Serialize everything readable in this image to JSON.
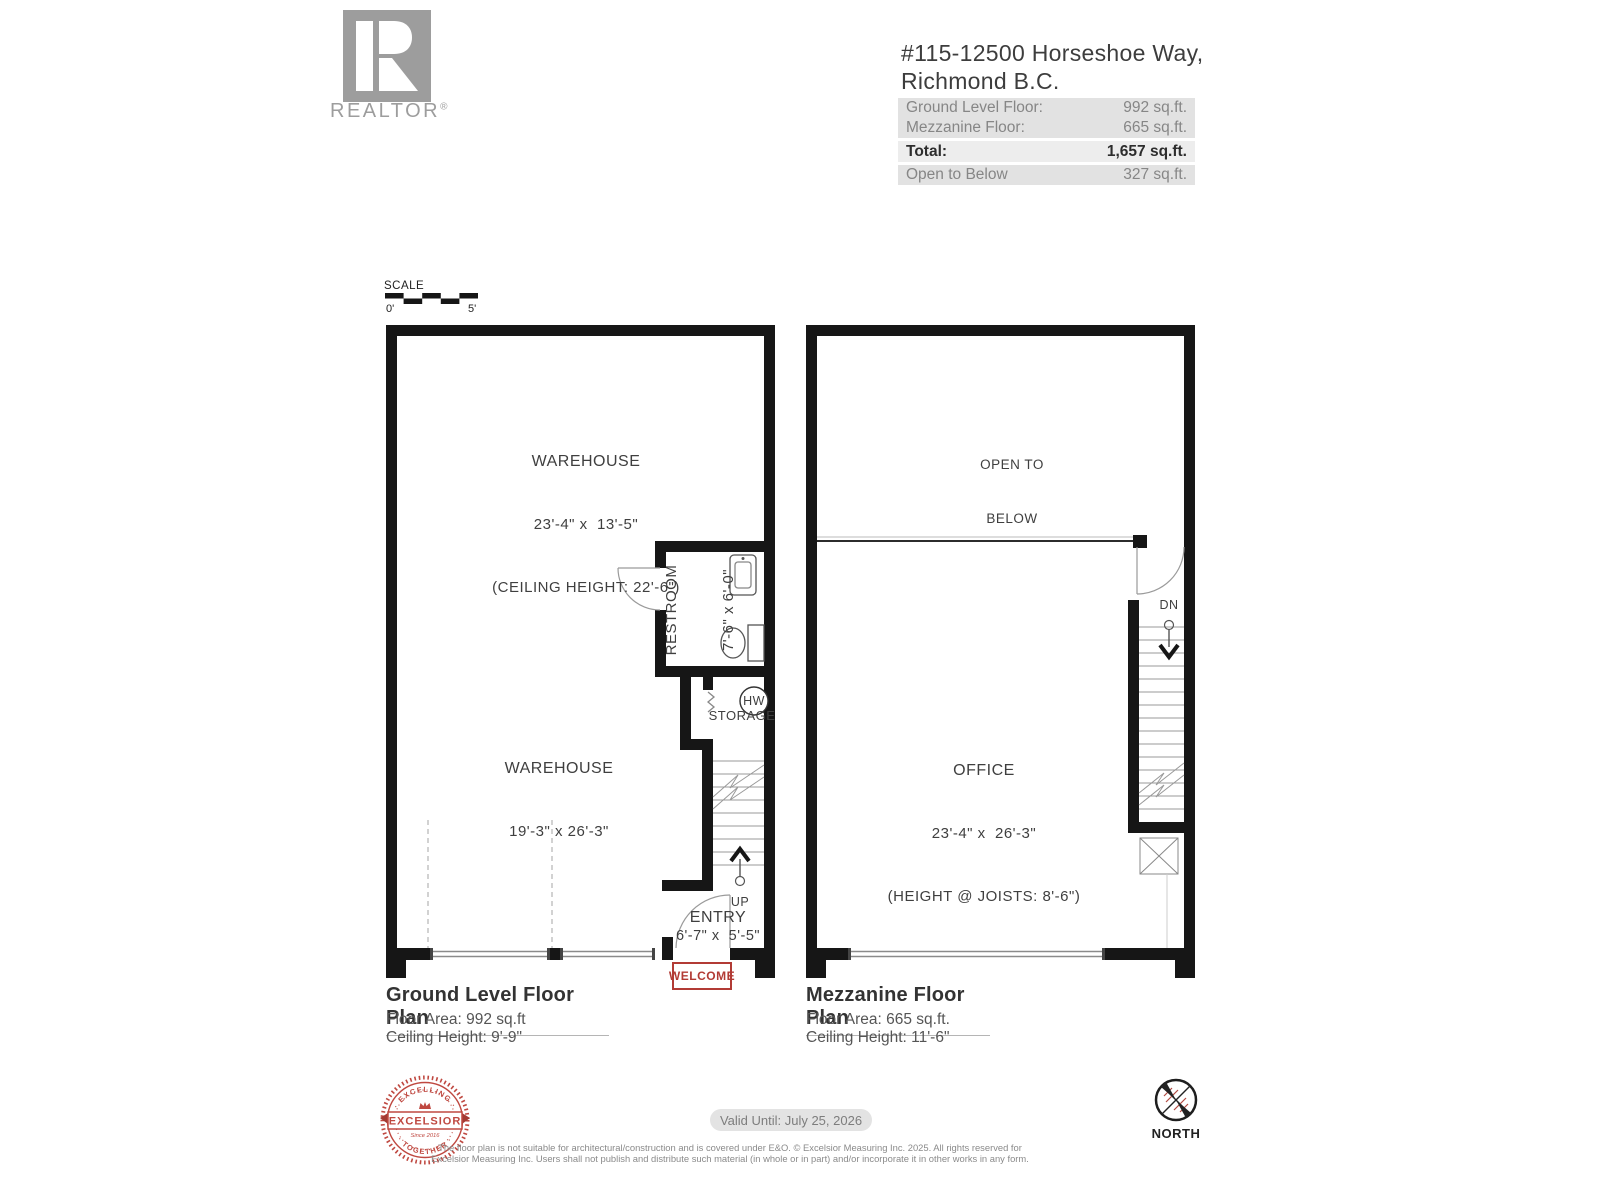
{
  "branding": {
    "realtor_label": "REALTOR",
    "registered_mark": "®"
  },
  "header": {
    "address_line1": "#115-12500 Horseshoe Way,",
    "address_line2": "Richmond B.C.",
    "area_rows": [
      {
        "label": "Ground Level Floor:",
        "value": "992 sq.ft."
      },
      {
        "label": "Mezzanine Floor:",
        "value": "665 sq.ft."
      },
      {
        "label": "Total:",
        "value": "1,657 sq.ft."
      },
      {
        "label": "Open to Below",
        "value": "327 sq.ft."
      }
    ]
  },
  "scale_bar": {
    "label": "SCALE",
    "start": "0'",
    "end": "5'"
  },
  "ground_floor": {
    "title": "Ground Level Floor Plan",
    "floor_area": "Floor Area: 992 sq.ft",
    "ceiling_height": "Ceiling Height: 9'-9\"",
    "warehouse_upper": {
      "name": "WAREHOUSE",
      "dims": "23'-4\" x  13'-5\"",
      "note": "(CEILING HEIGHT: 22'-6\")"
    },
    "warehouse_lower": {
      "name": "WAREHOUSE",
      "dims": "19'-3\" x 26'-3\""
    },
    "restroom": {
      "name": "RESTROOM",
      "dims": "7'-6\" x 6'-0\""
    },
    "hw_label": "HW",
    "storage_label": "STORAGE",
    "up_label": "UP",
    "entry": {
      "name": "ENTRY",
      "dims": "6'-7\" x  5'-5\""
    },
    "welcome_label": "WELCOME"
  },
  "mezzanine_floor": {
    "title": "Mezzanine Floor Plan",
    "floor_area": "Floor Area: 665 sq.ft.",
    "ceiling_height": "Ceiling Height: 11'-6\"",
    "open_to_below_line1": "OPEN TO",
    "open_to_below_line2": "BELOW",
    "office": {
      "name": "OFFICE",
      "dims": "23'-4\" x  26'-3\"",
      "note": "(HEIGHT @ JOISTS: 8'-6\")"
    },
    "dn_label": "DN"
  },
  "footer": {
    "excelsior_badge": {
      "arc_top": "· EXCELLING ·",
      "ribbon": "EXCELSIOR",
      "since": "Since 2016",
      "arc_bottom": "· TOGETHER ·"
    },
    "valid_until": "Valid Until: July 25, 2026",
    "disclaimer_line1": "The floor plan is not suitable for architectural/construction and is covered under E&O. © Excelsior Measuring Inc. 2025. All rights reserved for",
    "disclaimer_line2": "Excelsior Measuring Inc. Users shall not publish and distribute such material (in whole or in part) and/or incorporate it in other works in any form.",
    "north_label": "NORTH"
  }
}
